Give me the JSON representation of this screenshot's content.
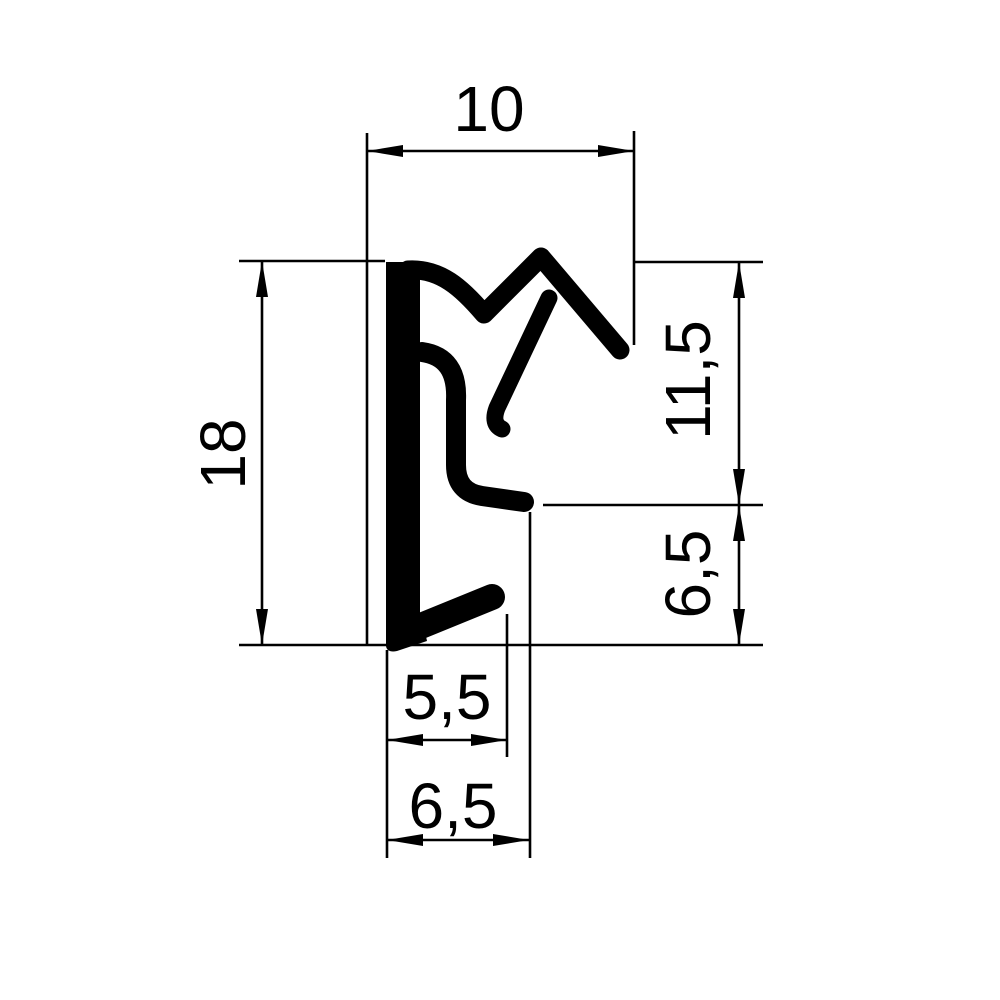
{
  "drawing": {
    "kind": "technical-drawing",
    "background_color": "#ffffff",
    "line_color": "#000000",
    "dimensions": {
      "top_width": "10",
      "left_height": "18",
      "right_upper_height": "11,5",
      "right_lower_height": "6,5",
      "bottom_inner_width": "5,5",
      "bottom_overall_width": "6,5"
    },
    "geometry": {
      "extension_lines": [
        {
          "name": "ext-top-width-left",
          "x1": 367,
          "y1": 133,
          "x2": 367,
          "y2": 646
        },
        {
          "name": "ext-top-width-right",
          "x1": 634,
          "y1": 131,
          "x2": 634,
          "y2": 345
        },
        {
          "name": "ext-left-height-top",
          "x1": 239,
          "y1": 261,
          "x2": 385,
          "y2": 261
        },
        {
          "name": "ext-baseline-bottom",
          "x1": 239,
          "y1": 645,
          "x2": 763,
          "y2": 645
        },
        {
          "name": "ext-right-upper-top",
          "x1": 634,
          "y1": 262,
          "x2": 763,
          "y2": 262
        },
        {
          "name": "ext-right-middle",
          "x1": 543,
          "y1": 505,
          "x2": 763,
          "y2": 505
        },
        {
          "name": "ext-bottom-left",
          "x1": 387,
          "y1": 650,
          "x2": 387,
          "y2": 858
        },
        {
          "name": "ext-bottom-inner-right",
          "x1": 507,
          "y1": 614,
          "x2": 507,
          "y2": 757
        },
        {
          "name": "ext-bottom-outer-right",
          "x1": 530,
          "y1": 512,
          "x2": 530,
          "y2": 858
        }
      ],
      "dimension_lines": [
        {
          "name": "dimline-top-width",
          "x1": 367,
          "y1": 151,
          "x2": 634,
          "y2": 151,
          "arrows": [
            {
              "x": 367,
              "y": 151,
              "dir": "left"
            },
            {
              "x": 634,
              "y": 151,
              "dir": "right"
            }
          ]
        },
        {
          "name": "dimline-left-height",
          "x1": 262,
          "y1": 261,
          "x2": 262,
          "y2": 645,
          "arrows": [
            {
              "x": 262,
              "y": 261,
              "dir": "up"
            },
            {
              "x": 262,
              "y": 645,
              "dir": "down"
            }
          ]
        },
        {
          "name": "dimline-right-upper",
          "x1": 739,
          "y1": 262,
          "x2": 739,
          "y2": 505,
          "arrows": [
            {
              "x": 739,
              "y": 262,
              "dir": "up"
            },
            {
              "x": 739,
              "y": 505,
              "dir": "down"
            }
          ]
        },
        {
          "name": "dimline-right-lower",
          "x1": 739,
          "y1": 505,
          "x2": 739,
          "y2": 645,
          "arrows": [
            {
              "x": 739,
              "y": 505,
              "dir": "up"
            },
            {
              "x": 739,
              "y": 645,
              "dir": "down"
            }
          ]
        },
        {
          "name": "dimline-bottom-inner",
          "x1": 387,
          "y1": 740,
          "x2": 507,
          "y2": 740,
          "arrows": [
            {
              "x": 387,
              "y": 740,
              "dir": "left"
            },
            {
              "x": 507,
              "y": 740,
              "dir": "right"
            }
          ]
        },
        {
          "name": "dimline-bottom-outer",
          "x1": 387,
          "y1": 840,
          "x2": 529,
          "y2": 840,
          "arrows": [
            {
              "x": 387,
              "y": 840,
              "dir": "left"
            },
            {
              "x": 529,
              "y": 840,
              "dir": "right"
            }
          ]
        }
      ],
      "arrow_length": 36,
      "arrow_half_width": 6
    }
  }
}
